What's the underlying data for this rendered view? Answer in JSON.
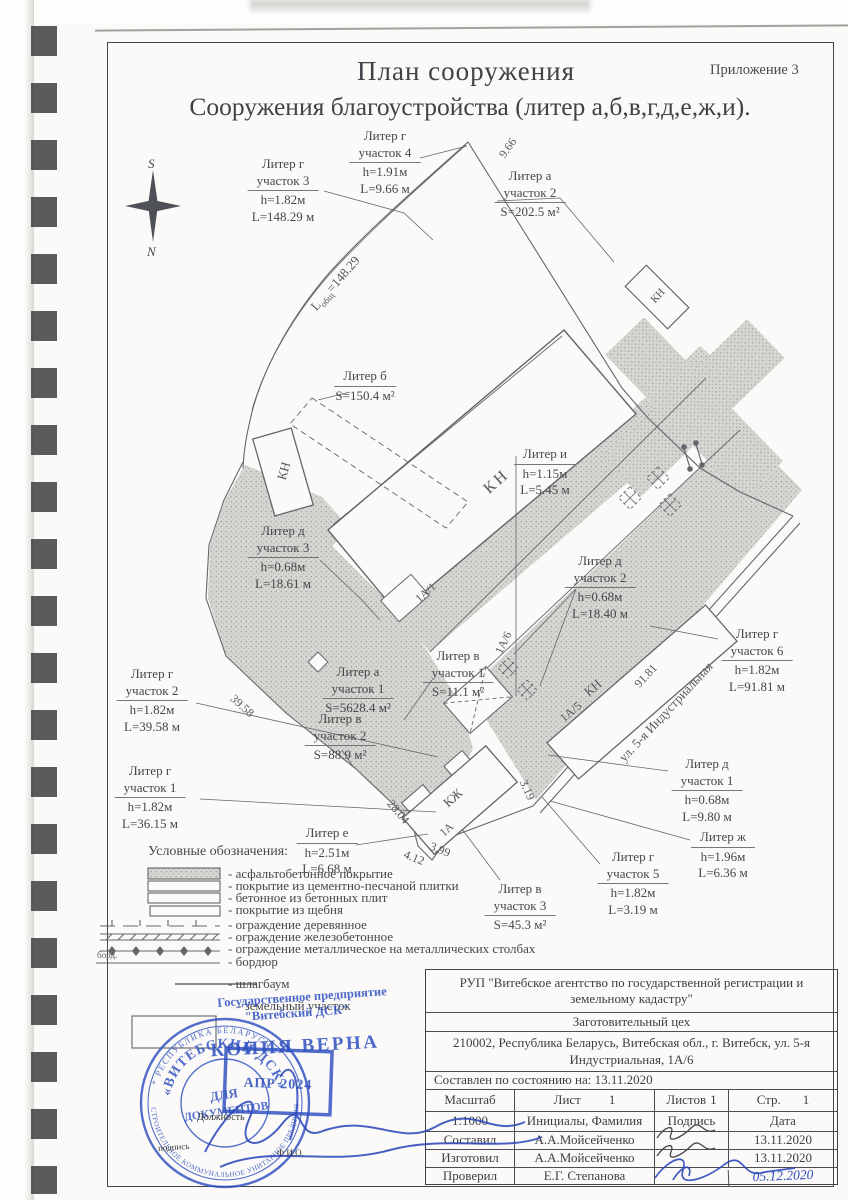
{
  "page": {
    "appendix": "Приложение 3",
    "title_line1": "План сооружения",
    "title_line2": "Сооружения  благоустройства (литер а,б,в,г,д,е,ж,и)."
  },
  "compass": {
    "south": "S",
    "north": "N"
  },
  "plan": {
    "annotations": [
      {
        "title": "Литер г\nучасток 3",
        "detail": "h=1.82м\nL=148.29 м"
      },
      {
        "title": "Литер г\nучасток 4",
        "detail": "h=1.91м\nL=9.66 м"
      },
      {
        "title": "Литер а\nучасток 2",
        "detail": "S=202.5 м²"
      },
      {
        "title": "Литер б",
        "detail": "S=150.4 м²"
      },
      {
        "title": "Литер и",
        "detail": "h=1.15м\nL=5.45 м"
      },
      {
        "title": "Литер д\nучасток 3",
        "detail": "h=0.68м\nL=18.61 м"
      },
      {
        "title": "Литер д\nучасток 2",
        "detail": "h=0.68м\nL=18.40 м"
      },
      {
        "title": "Литер г\nучасток 6",
        "detail": "h=1.82м\nL=91.81 м"
      },
      {
        "title": "Литер а\nучасток 1",
        "detail": "S=5628.4 м²"
      },
      {
        "title": "Литер в\nучасток 1",
        "detail": "S=11.1 м²"
      },
      {
        "title": "Литер в\nучасток 2",
        "detail": "S=88.9 м²"
      },
      {
        "title": "Литер г\nучасток 2",
        "detail": "h=1.82м\nL=39.58 м"
      },
      {
        "title": "Литер г\nучасток 1",
        "detail": "h=1.82м\nL=36.15 м"
      },
      {
        "title": "Литер е",
        "detail": "h=2.51м\nL=6.68 м"
      },
      {
        "title": "Литер в\nучасток 3",
        "detail": "S=45.3 м²"
      },
      {
        "title": "Литер г\nучасток 5",
        "detail": "h=1.82м\nL=3.19 м"
      },
      {
        "title": "Литер д\nучасток 1",
        "detail": "h=0.68м\nL=9.80 м"
      },
      {
        "title": "Литер ж",
        "detail": "h=1.96м\nL=6.36 м"
      }
    ],
    "tags": [
      "КН",
      "КН",
      "КН",
      "КН",
      "1А/5",
      "1А/1",
      "1А/6",
      "КЖ",
      "1А"
    ],
    "street": "ул. 5-я Индустриальная",
    "dims": [
      "9.66",
      "39.58",
      "28.04",
      "4.12",
      "3.99",
      "3.19",
      "91.81"
    ],
    "dim_total": {
      "prefix": "L",
      "sub": "общ",
      "value": "=148.29"
    }
  },
  "legend": {
    "heading": "Условные обозначения:",
    "bord": "борд.",
    "items": [
      "- асфальтобетонное  покрытие",
      "- покрытие из цементно-песчаной плитки",
      "- бетонное из бетонных плит",
      "- покрытие из щебня",
      "- ограждение деревянное",
      "- ограждение железобетонное",
      "- ограждение металлическое на металлических столбах",
      "- бордюр",
      "- шлагбаум",
      "- земельный участок"
    ]
  },
  "stamps": {
    "circle_top": "* РЕСПУБЛИКА БЕЛАРУСЬ *",
    "circle_bottom": "СТРОИТЕЛЬНОЕ КОММУНАЛЬНОЕ УНИТАРНОЕ ПРЕДПРИЯТИЕ",
    "circle_ring": "«ВИТЕБСКИЙ ДСК»",
    "center1": "ДЛЯ",
    "center2": "ДОКУМЕНТОВ",
    "enterprise_line1": "Государственное предприятие",
    "enterprise_line2": "\"Витебский ДСК\"",
    "copy": "КОПИЯ ВЕРНА",
    "date": "АПР  2024",
    "pos": "Должность",
    "sign": "подпись",
    "fio": "Ф.И.О."
  },
  "table": {
    "org": "РУП \"Витебское агентство по государственной регистрации и земельному кадастру\"",
    "dept": "Заготовительный цех",
    "address": "210002, Республика Беларусь, Витебская обл., г. Витебск, ул. 5-я Индустриальная, 1А/6",
    "status": "Составлен по состоянию на: 13.11.2020",
    "scale_label": "Масштаб",
    "scale_value": "1:1000",
    "sheet_label": "Лист",
    "sheet_value": "1",
    "sheets_label": "Листов",
    "sheets_value": "1",
    "page_label": "Стр.",
    "page_value": "1",
    "name_header": "Инициалы, Фамилия",
    "sign_header": "Подпись",
    "date_header": "Дата",
    "rows": [
      {
        "role": "Составил",
        "name": "А.А.Мойсейченко",
        "date": "13.11.2020"
      },
      {
        "role": "Изготовил",
        "name": "А.А.Мойсейченко",
        "date": "13.11.2020"
      },
      {
        "role": "Проверил",
        "name": "Е.Г. Степанова",
        "date": "05.12.2020"
      }
    ]
  }
}
